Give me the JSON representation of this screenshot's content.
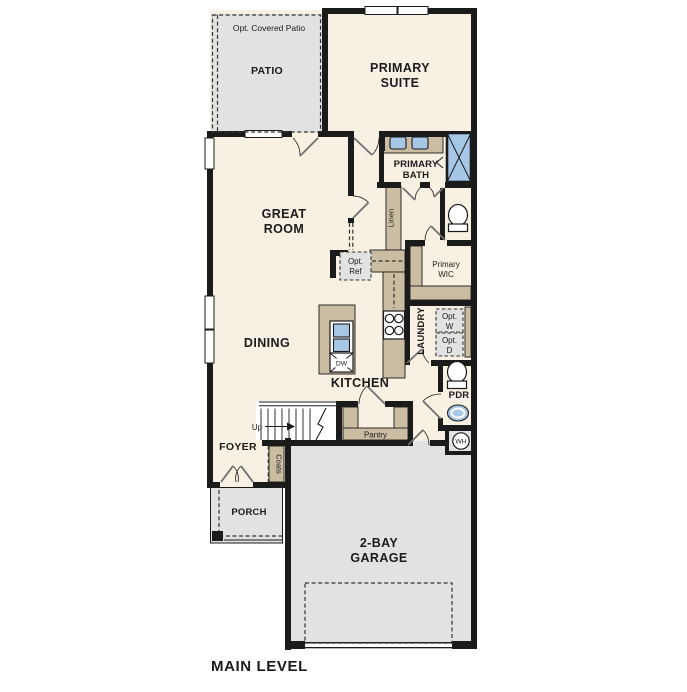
{
  "title": "MAIN LEVEL",
  "colors": {
    "interior": "#f8f0e2",
    "outdoor": "#e2e2e2",
    "cabinet": "#cbbda2",
    "fixture": "#a7c7e7",
    "wall": "#1b1b1b",
    "door": "#6e6e6e",
    "text": "#1b1b1b"
  },
  "rooms": {
    "patio": {
      "label": "PATIO",
      "optional": "Opt. Covered Patio"
    },
    "primary_suite": {
      "lines": [
        "PRIMARY",
        "SUITE"
      ]
    },
    "great_room": {
      "lines": [
        "GREAT",
        "ROOM"
      ]
    },
    "primary_bath": {
      "lines": [
        "PRIMARY",
        "BATH"
      ]
    },
    "primary_wic": {
      "lines": [
        "Primary",
        "WIC"
      ]
    },
    "dining": {
      "label": "DINING"
    },
    "kitchen": {
      "label": "KITCHEN"
    },
    "laundry": {
      "label": "LAUNDRY"
    },
    "pantry": {
      "label": "Pantry"
    },
    "powder": {
      "label": "PDR"
    },
    "foyer": {
      "label": "FOYER"
    },
    "porch": {
      "label": "PORCH"
    },
    "garage": {
      "lines": [
        "2-BAY",
        "GARAGE"
      ]
    }
  },
  "closets": {
    "linen": "Linen",
    "coats": "Coats"
  },
  "fixtures": {
    "opt_ref": {
      "lines": [
        "Opt.",
        "Ref"
      ]
    },
    "opt_washer": {
      "lines": [
        "Opt.",
        "W"
      ]
    },
    "opt_dryer": {
      "lines": [
        "Opt.",
        "D"
      ]
    },
    "dishwasher": "DW",
    "water_heater": "WH",
    "stairs": {
      "direction": "Up"
    }
  }
}
